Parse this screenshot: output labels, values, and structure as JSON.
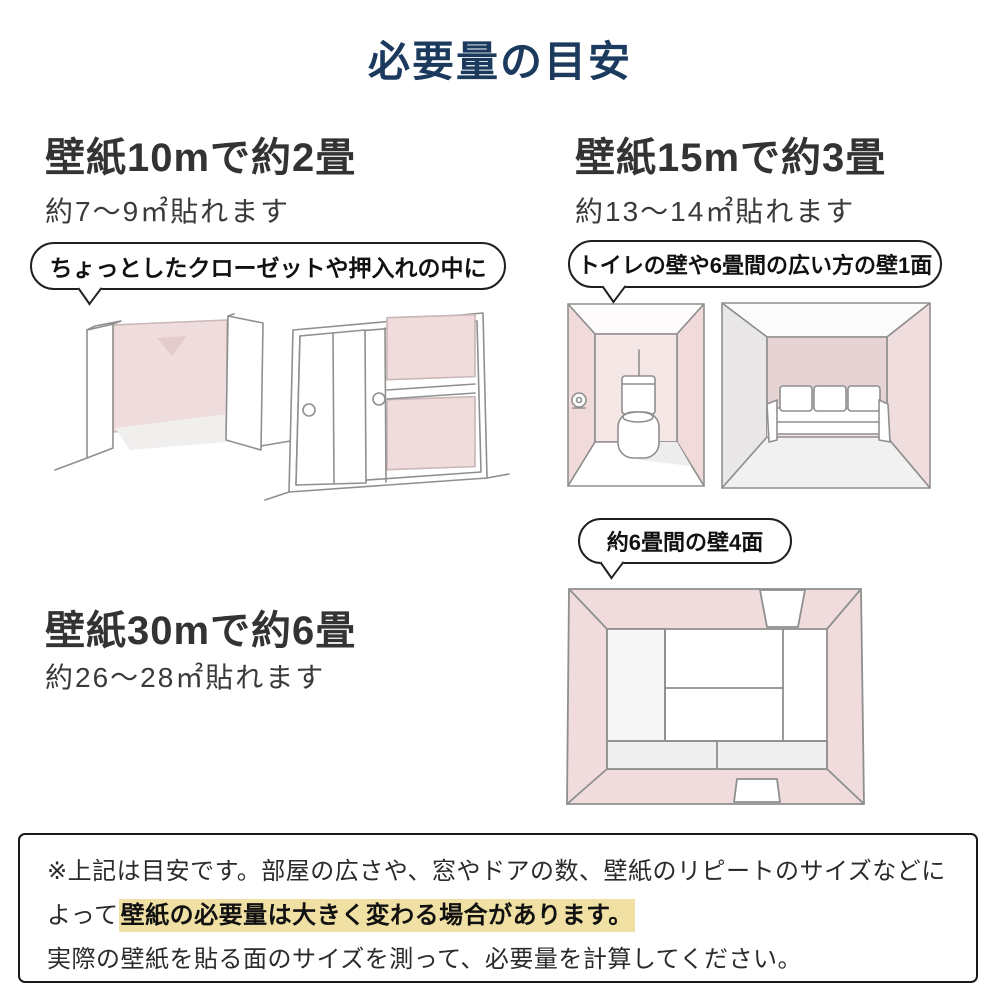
{
  "title": "必要量の目安",
  "sections": {
    "ten_m": {
      "heading": "壁紙10mで約2畳",
      "subtext": "約7〜9㎡貼れます",
      "bubble": "ちょっとしたクローゼットや押入れの中に",
      "illustrations": [
        "closet-open-doors",
        "closet-sliding-doors"
      ]
    },
    "fifteen_m": {
      "heading": "壁紙15mで約3畳",
      "subtext": "約13〜14㎡貼れます",
      "bubble": "トイレの壁や6畳間の広い方の壁1面",
      "illustrations": [
        "toilet-room",
        "sofa-room"
      ]
    },
    "thirty_m": {
      "heading": "壁紙30mで約6畳",
      "subtext": "約26〜28㎡貼れます",
      "bubble": "約6畳間の壁4面",
      "illustrations": [
        "six-tatami-room-top-view"
      ]
    }
  },
  "note": {
    "line1": "※上記は目安です。部屋の広さや、窓やドアの数、壁紙のリピートのサイズなどに",
    "line2_prefix": "よって",
    "line2_highlight": "壁紙の必要量は大きく変わる場合があります。",
    "line3": "実際の壁紙を貼る面のサイズを測って、必要量を計算してください。"
  },
  "colors": {
    "title_navy": "#1b3a5e",
    "heading_gray": "#333333",
    "wallpaper_pink": "#f0dcdc",
    "wallpaper_pink_dark": "#e6d3d3",
    "highlight_yellow": "#f0e0a4",
    "sketch_line_gray": "#8f8f8f"
  }
}
